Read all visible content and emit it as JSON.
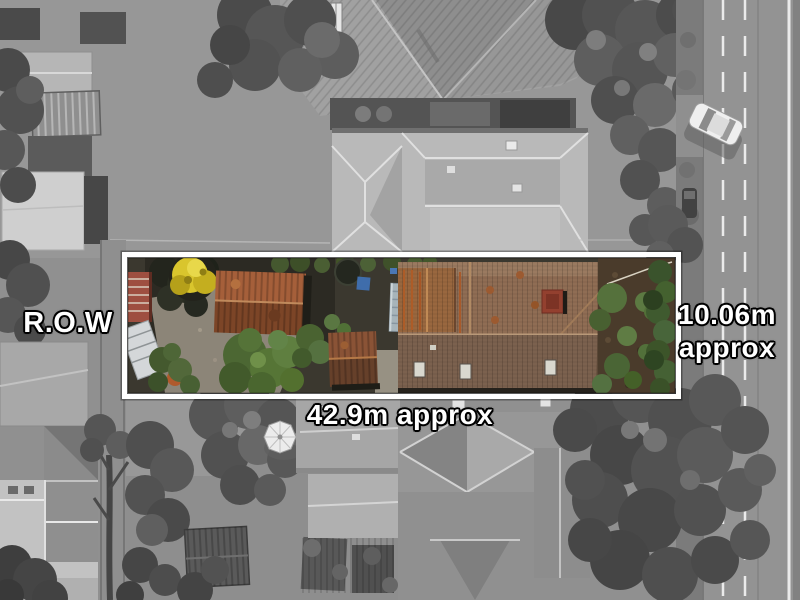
{
  "scene": {
    "type": "real-estate aerial photograph",
    "highlight_border_color": "#ffffff",
    "label_text_color": "#ffffff",
    "label_outline_color": "#000000"
  },
  "labels": {
    "right_of_way": "R.O.W",
    "width": {
      "line1": "10.06m",
      "line2": "approx"
    },
    "depth": "42.9m approx"
  }
}
